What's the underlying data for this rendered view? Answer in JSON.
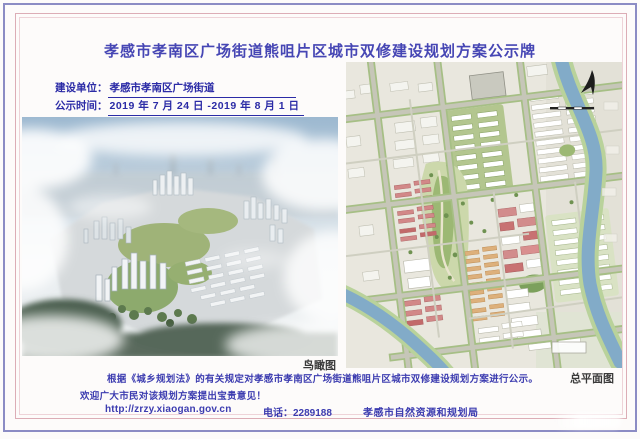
{
  "board": {
    "title": "孝感市孝南区广场街道熊咀片区城市双修建设规划方案公示牌",
    "info": {
      "builder_label": "建设单位：",
      "builder_value": "孝感市孝南区广场街道",
      "period_label": "公示时间：",
      "period_value": "2019 年 7 月 24 日 -2019 年 8 月 1 日"
    },
    "images": {
      "aerial_caption": "鸟瞰图",
      "plan_caption": "总平面图"
    },
    "notice": {
      "line1": "根据《城乡规划法》的有关规定对孝感市孝南区广场街道熊咀片区城市双修建设规划方案进行公示。",
      "line2": "欢迎广大市民对该规划方案提出宝贵意见！"
    },
    "footer": {
      "website": "http://zrzy.xiaogan.gov.cn",
      "phone": "电话：2289188",
      "agency": "孝感市自然资源和规划局"
    },
    "colors": {
      "title_text": "#4646b4",
      "info_text": "#2b2ba6",
      "notice_text": "#3c3cb0",
      "frame_outer": "#8c8cc4",
      "frame_inner": "#dcadb6",
      "river_blue": "#82abc8",
      "park_green": "#9cb874"
    }
  }
}
